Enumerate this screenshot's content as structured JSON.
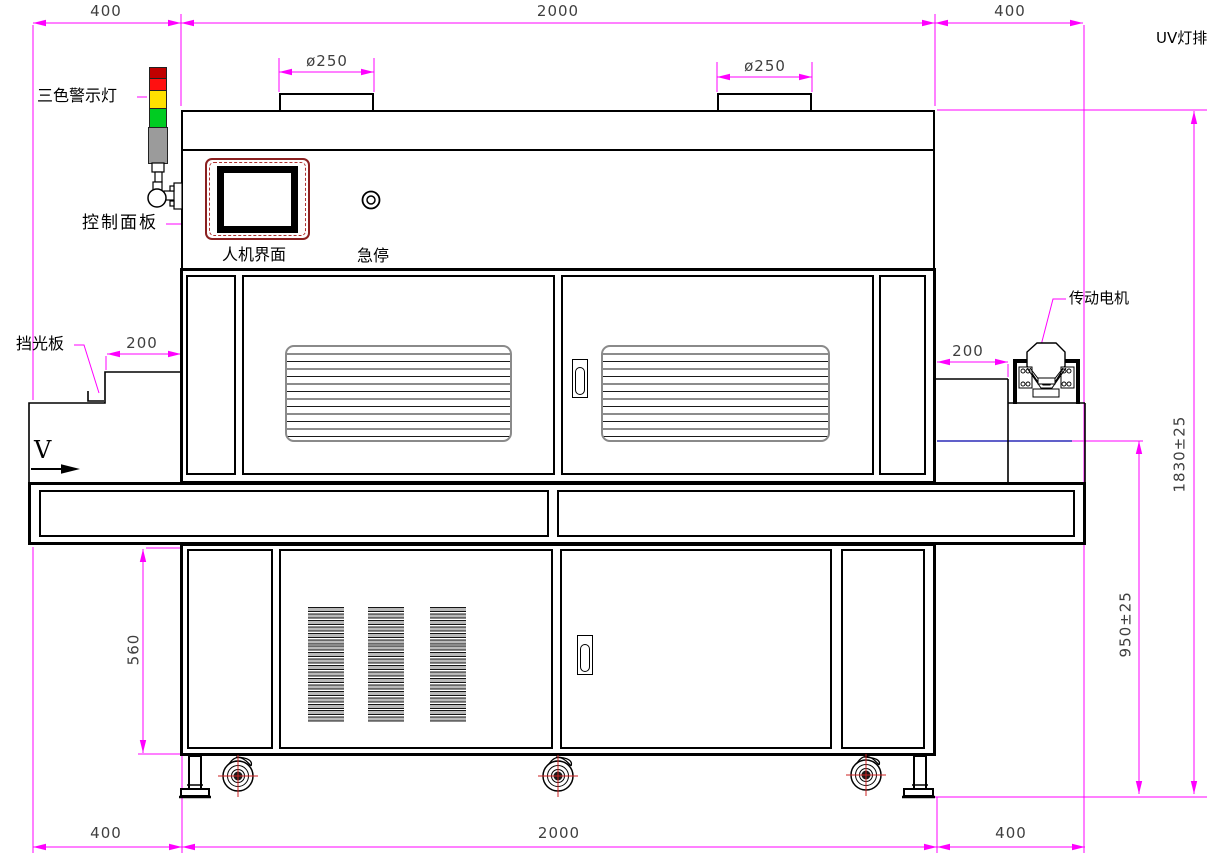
{
  "labels": {
    "warning_light": "三色警示灯",
    "control_panel": "控制面板",
    "hmi": "人机界面",
    "estop": "急停",
    "light_shield": "挡光板",
    "drive_motor": "传动电机",
    "uv_lamp_bank": "UV灯排",
    "direction": "V"
  },
  "dimensions": {
    "top": [
      "400",
      "2000",
      "400"
    ],
    "bottom": [
      "400",
      "2000",
      "400"
    ],
    "vent_dia_left": "ø250",
    "vent_dia_right": "ø250",
    "inlet_shelf": "200",
    "outlet_shelf": "200",
    "cabinet_height": "560",
    "belt_height": "950±25",
    "total_height": "1830±25"
  },
  "colors": {
    "dimension_line": "#FF00FF",
    "structure_line": "#000000",
    "belt_level_line": "#0000AA",
    "caster_mark": "#CC2222",
    "hmi_frame": "#8B2020",
    "light_red": "#FF1010",
    "light_yellow": "#FFE000",
    "light_green": "#00CC22",
    "light_gray": "#9B9B9B"
  }
}
